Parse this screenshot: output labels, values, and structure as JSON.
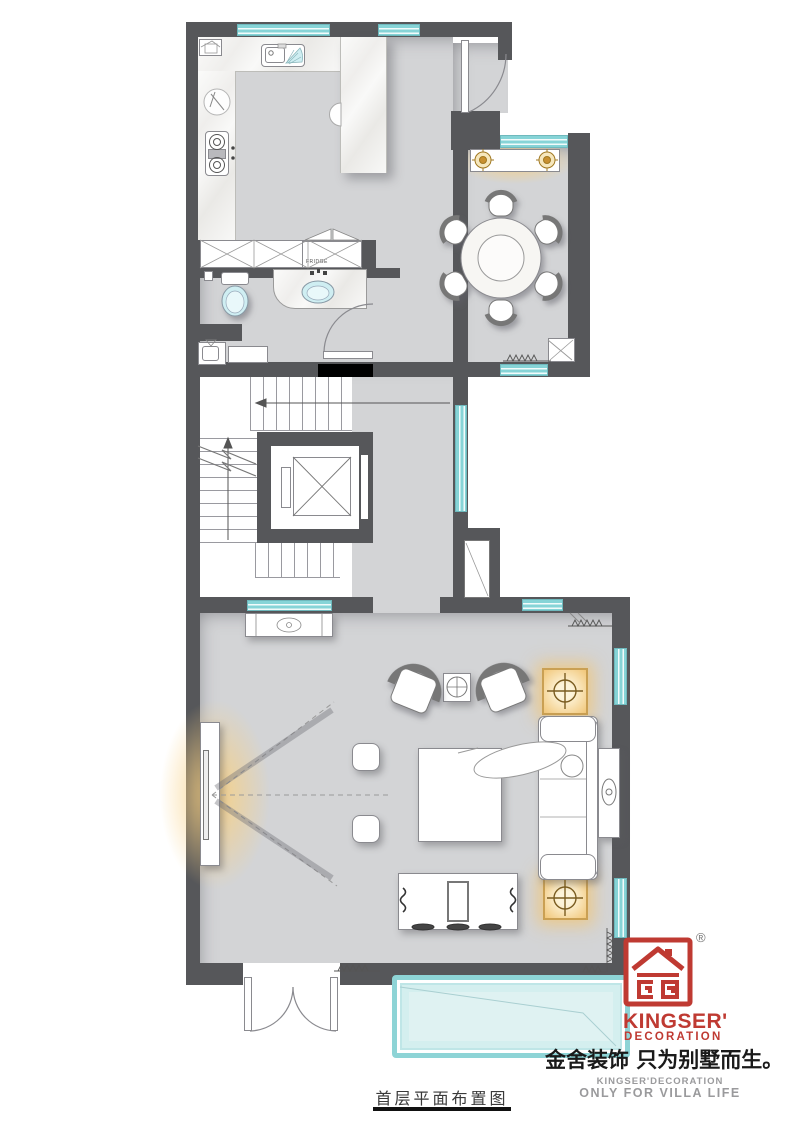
{
  "meta": {
    "type": "residential floor plan drawing",
    "floor_label": "首层平面布置图"
  },
  "branding": {
    "logo_symbol": "stylized 金 house mark in red square",
    "registered_mark": "®",
    "brand_en_line1": "KINGSER'",
    "brand_en_line2": "DECORATION",
    "slogan_cn": "金舍装饰 只为别墅而生。",
    "sub_brand_en": "KINGSER'DECORATION",
    "sub_slogan_en": "ONLY FOR VILLA LIFE"
  },
  "labels": {
    "fridge": "FRIDGE"
  },
  "colors": {
    "wall": "#56575a",
    "floor": "#d3d4d6",
    "window_teal": "#86d4d7",
    "bay_window_fill": "#dff2f2",
    "fixture_teal": "#cfeef2",
    "accent_gold": "#caa053",
    "glow_warm": "#f6d8a0",
    "brand_red": "#bf3a32",
    "text_gray": "#9a9a9c",
    "black_accent": "#000000"
  },
  "icons": [
    "kitchen-sink-icon",
    "cooktop-icon",
    "cutting-board-icon",
    "fridge-icon",
    "toilet-icon",
    "washbasin-icon",
    "mop-sink-icon",
    "washer-cabinet-icon",
    "stairs-icon",
    "elevator-icon",
    "direction-arrow-icon",
    "break-line-icon",
    "dining-table-icon",
    "dining-chair-icon",
    "console-lamp-icon",
    "armchair-icon",
    "side-table-icon",
    "coffee-table-icon",
    "stool-icon",
    "sofa-icon",
    "person-icon",
    "sofa-console-icon",
    "lamp-table-icon",
    "tv-panel-icon",
    "tv-cabinet-icon",
    "radiator-icon",
    "door-swing-icon",
    "double-door-icon",
    "window-icon",
    "bay-window-icon",
    "flue-shaft-icon",
    "kingser-logo-icon",
    "registered-trademark-icon"
  ],
  "plan_elements": [
    "kitchen with L-shaped marble counter, sink, cooktop and fridge",
    "entry hall with inward-swinging entry door",
    "dining room with round 6-seat table and lamp console",
    "bathroom with toilet and marble vanity basin",
    "utility corner with mop sink and cabinet",
    "staircase wrapping elevator shaft",
    "corridor with teal windows and flue shaft niche",
    "living room with two armchairs, coffee table, sofa, person figure",
    "wall-mounted TV panel with warm glow and viewing lines",
    "TV media cabinet with scroll ends",
    "two glowing gold lamp tables beside sofa",
    "radiators in dining and living room corners",
    "double entry door at bottom wall",
    "large teal bay window at bottom"
  ]
}
